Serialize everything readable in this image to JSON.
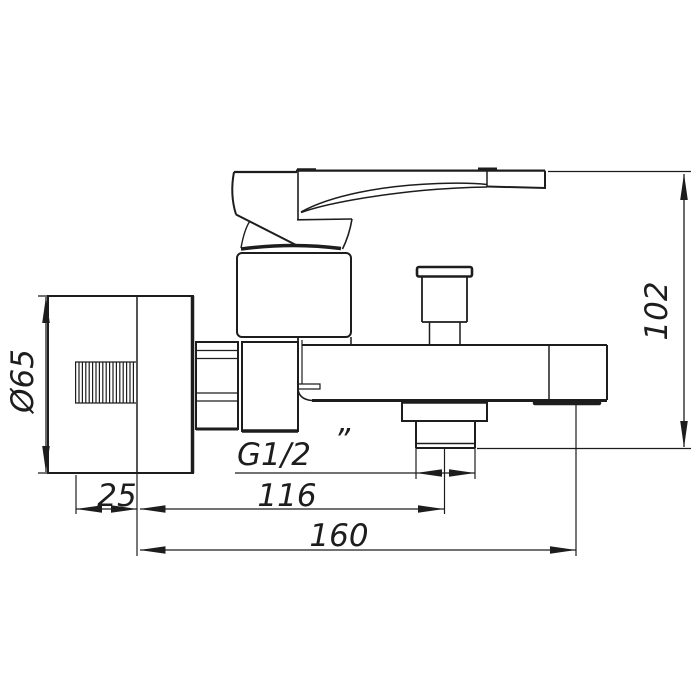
{
  "colors": {
    "ink": "#1d1d1d",
    "background": "#ffffff"
  },
  "drawing": {
    "dimensions": {
      "flange_diameter": "Ø65",
      "flange_offset": "25",
      "thread_size": "G1/2",
      "thread_inch_mark": "”",
      "outlet_center_distance": "116",
      "spout_reach": "160",
      "body_height": "102"
    }
  }
}
